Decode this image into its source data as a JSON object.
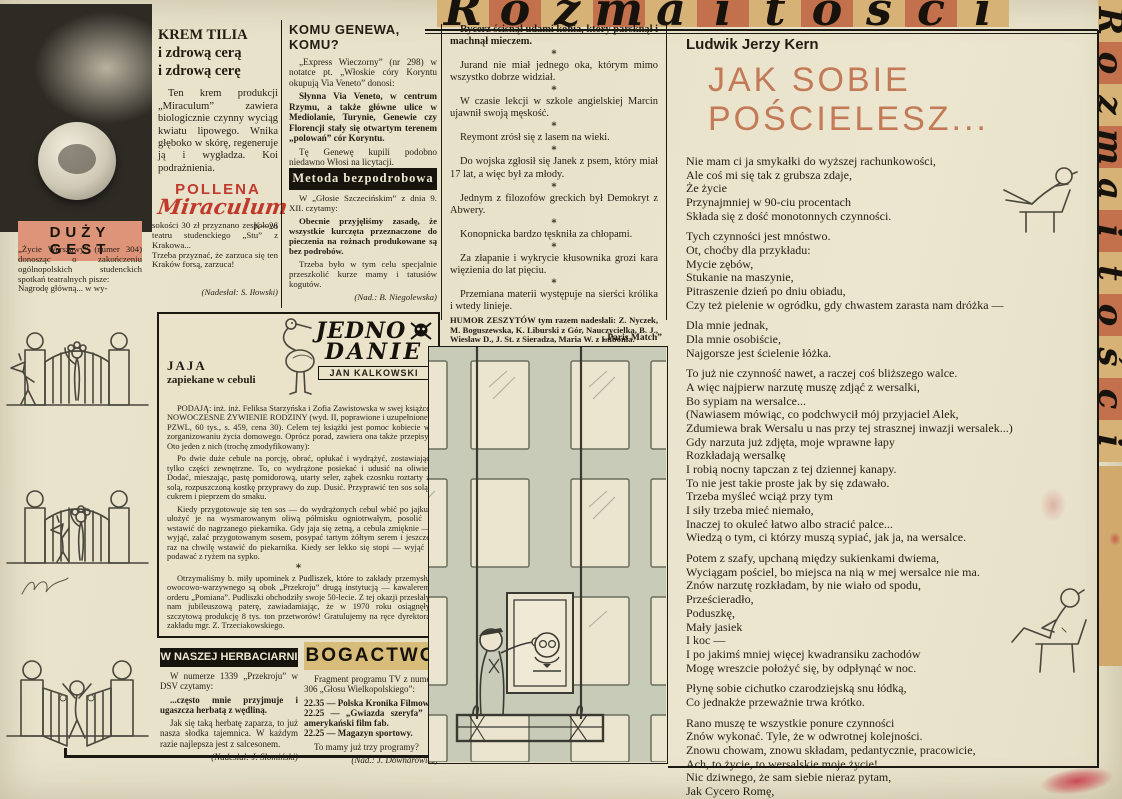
{
  "banner": {
    "title": "Rozmaitości",
    "letters": [
      "R",
      "o",
      "z",
      "m",
      "a",
      "i",
      "t",
      "o",
      "ś",
      "c",
      "i"
    ]
  },
  "colors": {
    "paper": "#e8e2cb",
    "banner_tan": "#d6b277",
    "banner_salmon": "#c3714c",
    "header_pink": "#dd9478",
    "header_tan": "#d8bd7a",
    "bar_black": "#17140e",
    "logo_red": "#c0392b",
    "poem_title_salmon": "#c27a57",
    "facade_green": "#c7cbb8"
  },
  "advert": {
    "title": "KREM TILIA\ni zdrową cerą\ni zdrową cerę",
    "body": "Ten krem produkcji „Miraculum” zawiera biologicznie czynny wyciąg kwiatu lipowego. Wnika głęboko w skórę, regeneruje ją i wygładza. Koi podrażnienia.",
    "brand_top": "POLLENA",
    "brand_script": "Miraculum",
    "code": "K—26"
  },
  "komu": {
    "heading": "KOMU GENEWA, KOMU?",
    "p1": "„Express Wieczorny” (nr 298) w notatce pt. „Włoskie córy Koryntu okupują Via Veneto” donosi:",
    "p2": "Słynna Via Veneto, w centrum Rzymu, a także główne ulice w Mediolanie, Turynie, Genewie czy Florencji stały się otwartym terenem „polowań” cór Koryntu.",
    "p3": "Tę Genewę kupili podobno niedawno Włosi na licytacji.",
    "credit": "(Nad.: S. Szostakiewicz)"
  },
  "metoda": {
    "heading": "Metoda bezpodrobowa",
    "p1": "W „Głosie Szczecińskim” z dnia 9. XII. czytamy:",
    "p2": "Obecnie przyjęliśmy zasadę, że wszystkie kurczęta przeznaczone do pieczenia na rożnach produkowane są bez podrobów.",
    "p3": "Trzeba było w tym celu specjalnie przeszkolić kurze mamy i tatusiów kogutów.",
    "credit": "(Nad.: B. Niegolewska)"
  },
  "duzy": {
    "heading": "DUŻY GEST",
    "col1": "„Życie Warszawy” (numer 304) donosząc o zakończeniu ogólnopolskich studenckich spotkań teatralnych pisze:\nNagrodę główną... w wy-",
    "col2": "sokości 30 zł przyznano zespołowi teatru studenckiego „Stu” z Krakowa...\nTrzeba przyznać, że zarzuca się ten Kraków forsą, zarzuca!",
    "credit": "(Nadesłał: S. Iłowski)"
  },
  "jedno": {
    "logo_line1": "JEDNO",
    "logo_line2": "DANIE",
    "logo_line3": "JAN KALKOWSKI",
    "title": "JAJA",
    "subtitle": "zapiekane w cebuli",
    "p1": "PODAJĄ: inż. inż. Feliksa Starzyńska i Zofia Zawistowska w swej książce NOWOCZESNE ŻYWIENIE RODZINY (wyd. II, poprawione i uzupełnione; PZWL, 60 tys., s. 459, cena 30). Celem tej książki jest pomoc kobiecie w zorganizowaniu życia domowego. Oprócz porad, zawiera ona także przepisy. Oto jeden z nich (trochę zmodyfikowany):",
    "p2": "Po dwie duże cebule na porcję, obrać, opłukać i wydrążyć, zostawiając tylko części zewnętrzne. To, co wydrążone posiekać i udusić na oliwie. Dodać, mieszając, pastę pomidorową, utarty seler, ząbek czosnku roztarty z solą, rozpuszczoną kostkę przyprawy do zup. Dusić. Przyprawić ten sos solą, cukrem i pieprzem do smaku.",
    "p3": "Kiedy przygotowuje się ten sos — do wydrążonych cebul wbić po jajku, ułożyć je na wysmarowanym oliwą półmisku ogniotrwałym, posolić i wstawić do nagrzanego piekarnika. Gdy jaja się zetną, a cebula zmięknie — wyjąć, zalać przygotowanym sosem, posypać tartym żółtym serem i jeszcze raz na chwilę wstawić do piekarnika. Kiedy ser lekko się stopi — wyjąć i podawać z ryżem na sypko.",
    "p4": "Otrzymaliśmy b. miły upominek z Pudliszek, które to zakłady przemysłu owocowo-warzywnego są obok „Przekroju” drugą instytucją — kawalerem orderu „Pomiana”. Pudliszki obchodziły swoje 50-lecie. Z tej okazji przesłały nam jubileuszową paterę, zawiadamiając, że w 1970 roku osiągnęły szczytową produkcję 8 tys. ton przetworów! Gratulujemy na ręce dyrektora zakładu mgr. Z. Trzeciakowskiego."
  },
  "herbaciarnia": {
    "heading": "W NASZEJ HERBACIARNI",
    "p1": "W numerze 1339 „Przekroju” w DSV czytamy:",
    "p2": "...często mnie przyjmuje i ugaszcza herbatą z wędliną.",
    "p3": "Jak się taką herbatę zaparza, to już nasza słodka tajemnica. W każdym razie najlepsza jest z salcesonem.",
    "credit": "(Nadesłał: J. Słomiński)"
  },
  "bogactwo": {
    "heading": "BOGACTWO",
    "p1": "Fragment programu TV z numeru 306 „Głosu Wielkopolskiego”:",
    "program": "22.35 — Polska Kronika Filmowa.\n22.25 — „Gwiazda szeryfa” — amerykański film fab.\n22.25 — Magazyn sportowy.",
    "p2": "To mamy już trzy programy?",
    "credit": "(Nad.: J. Downarowicz)"
  },
  "humor": {
    "star": "*",
    "jokes": [
      "Rycerz ścisnął udami konia, który parsknął i machnął mieczem.",
      "Jurand nie miał jednego oka, którym mimo wszystko dobrze widział.",
      "W czasie lekcji w szkole angielskiej Marcin ujawnił swoją męskość.",
      "Reymont zrósł się z lasem na wieki.",
      "Do wojska zgłosił się Janek z psem, który miał 17 lat, a więc był za młody.",
      "Jednym z filozofów greckich był Demokryt z Abwery.",
      "Konopnicka bardzo tęskniła za chłopami.",
      "Za złapanie i wykrycie kłusownika grozi kara więzienia do lat pięciu.",
      "Przemiana materii występuje na sierści królika i wtedy linieje."
    ],
    "footer": "HUMOR ZESZYTÓW tym razem nadesłali: Z. Nyczek, M. Boguszewska, K. Liburski z Gór, Nauczycielka, B. J., Wiesław D., J. St. z Sieradza, Maria W. z Lubonia.",
    "thanks": "Dziękujemy."
  },
  "cartoon": {
    "caption": "„Paris Match”"
  },
  "poem": {
    "author": "Ludwik Jerzy Kern",
    "title": "JAK SOBIE POŚCIELESZ...",
    "stanzas": [
      "Nie mam ci ja smykałki do wyższej rachunkowości,\nAle coś mi się tak z grubsza zdaje,\nŻe życie\nPrzynajmniej w 90-ciu procentach\nSkłada się z dość monotonnych czynności.",
      "Tych czynności jest mnóstwo.\nOt, choćby dla przykładu:\nMycie zębów,\nStukanie na maszynie,\nPitraszenie dzień po dniu obiadu,\nCzy też pielenie w ogródku, gdy chwastem zarasta nam dróżka —",
      "Dla mnie jednak,\nDla mnie osobiście,\nNajgorsze jest ścielenie łóżka.",
      "To już nie czynność nawet, a raczej coś bliższego walce.\nA więc najpierw narzutę muszę zdjąć z wersalki,\nBo sypiam na wersalce...\n(Nawiasem mówiąc, co podchwycił mój przyjaciel Alek,\nZdumiewa brak Wersalu u nas przy tej strasznej inwazji wersalek...)\nGdy narzuta już zdjęta, moje wprawne łapy\nRozkładają wersalkę\nI robią nocny tapczan z tej dziennej kanapy.\nTo nie jest takie proste jak by się zdawało.\nTrzeba myśleć wciąż przy tym\nI siły trzeba mieć niemało,\nInaczej to okuleć łatwo albo stracić palce...\nWiedzą o tym, ci którzy muszą sypiać, jak ja, na wersalce.",
      "Potem z szafy, upchaną między sukienkami dwiema,\nWyciągam pościel, bo miejsca na nią w mej wersalce nie ma.\nZnów narzutę rozkładam, by nie wiało od spodu,\nPrześcieradło,\nPoduszkę,\nMały jasiek\nI koc —\nI po jakimś mniej więcej kwadransiku zachodów\nMogę wreszcie położyć się, by odpłynąć w noc.",
      "Płynę sobie cichutko czarodziejską snu łódką,\nCo jednakże przeważnie trwa krótko.",
      "Rano muszę te wszystkie ponure czynności\nZnów wykonać. Tyle, że w odwrotnej kolejności.\nZnowu chowam, znowu składam, pedantycznie, pracowicie,\nAch, to życie, to wersalskie moje życie!\nNic dziwnego, że sam siebie nieraz pytam,\nJak Cycero Romę,\nCzy nie warto w tych warunkach sypiać częściej poza domem?"
    ]
  }
}
